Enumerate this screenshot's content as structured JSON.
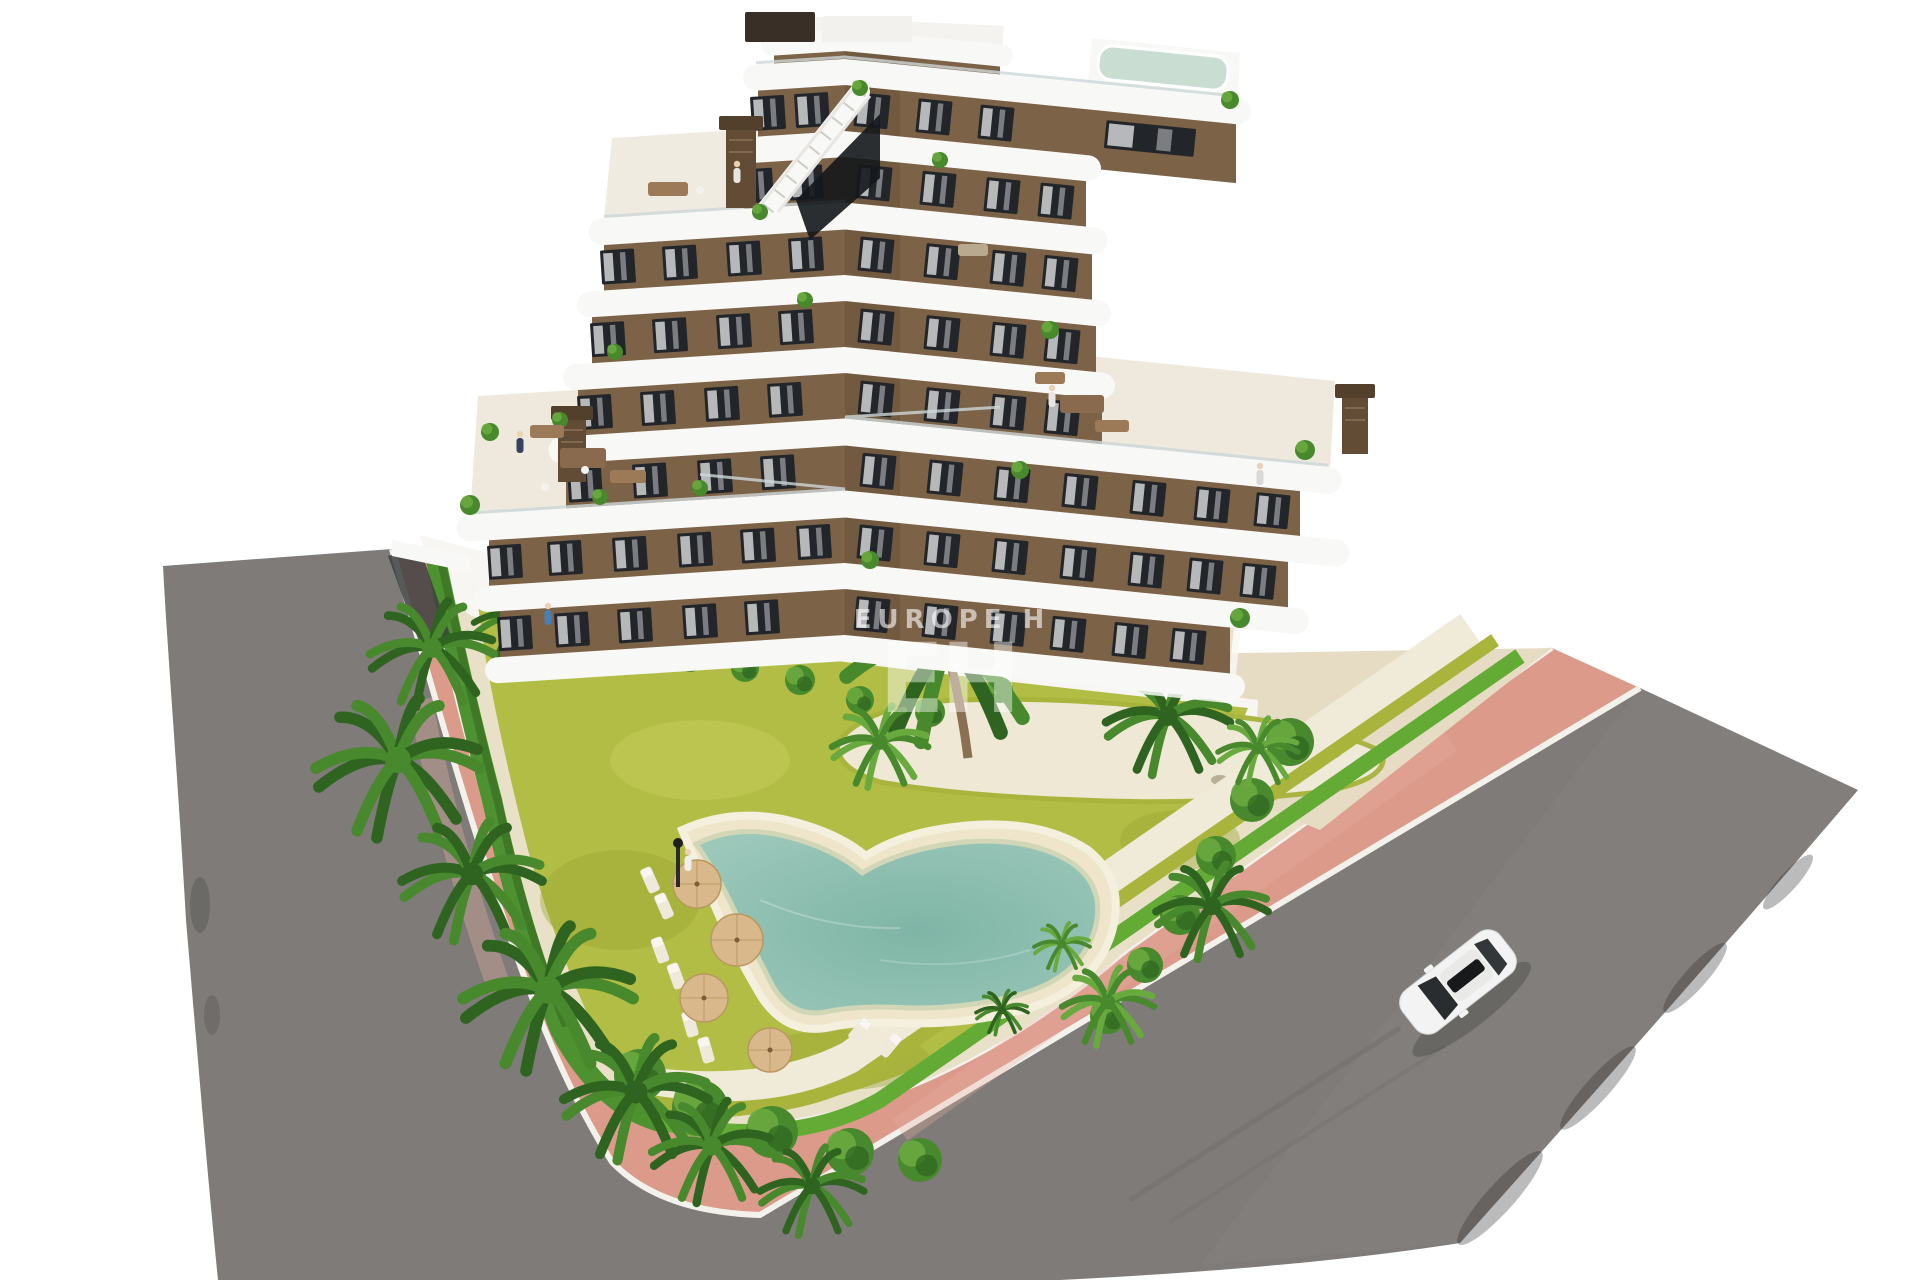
{
  "scene": {
    "description": "Aerial 3D architectural render of a modern white and brown apartment building with curved wavy balconies, rooftop terraces and plunge pool, landscaped garden with lagoon-style swimming pool, palm trees, pink paved sidewalks, asphalt roads and a single white car",
    "watermark": {
      "text_line": "EUROPE H",
      "monogram": "EH"
    }
  },
  "palette": {
    "bg": "#ffffff",
    "road": "#7e7b78",
    "road_light": "#8b8885",
    "road_mark": "#6f6c69",
    "road_shadow": "#2e2c2a",
    "sidewalk": "#dc9a8b",
    "sidewalk_light": "#e7b0a2",
    "curb": "#f3f1ec",
    "base_ground": "#e9e0c8",
    "apron": "#f7f6f2",
    "lawn": "#b2bd45",
    "lawn_light": "#c6cf5c",
    "lawn_dark": "#96a531",
    "hedge": "#4e9130",
    "hedge_dark": "#35691f",
    "hedge_bright": "#63ab35",
    "hedge_yellow": "#a9b43d",
    "palm_dark": "#2e6420",
    "palm_mid": "#47892c",
    "palm_light": "#69aa3f",
    "trunk": "#8a6f52",
    "sand": "#eee5cb",
    "sand_light": "#f5efdd",
    "pebble": "#f0ead9",
    "rock": "#b9ae97",
    "pool_rim": "#cfd6b4",
    "pool_water": "#9cc8ba",
    "pool_deep": "#7fb5a6",
    "pool_pale": "#c9ddd3",
    "white": "#f8f8f6",
    "white_shadow": "#d8d5cf",
    "brown": "#7c6246",
    "brown_dark": "#634c35",
    "brown_deep": "#52402c",
    "window": "#22262b",
    "curtain": "#e9e9ea",
    "glass": "#ccd7d9",
    "travertine": "#e6dcc4",
    "deckwood": "#2c241e",
    "furn_wood": "#8a6a4e",
    "furn_light": "#efe9dc",
    "umbrella": "#d9b98c",
    "umbrella_edge": "#b9985f",
    "car_body": "#f2f3f2",
    "car_glass": "#2a2d30",
    "skin": "#ecd2b5",
    "watermark": "#ffffff"
  }
}
